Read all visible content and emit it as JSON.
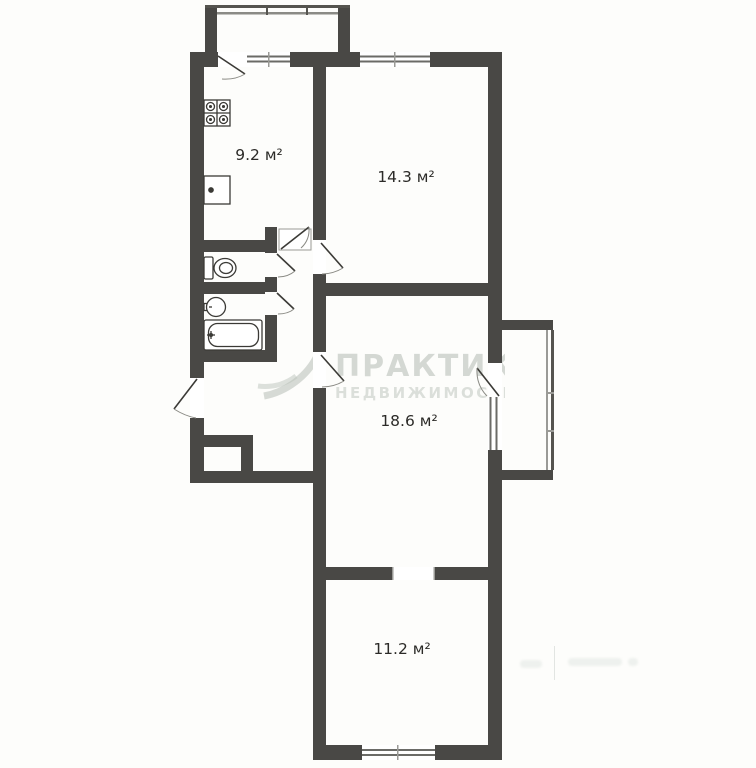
{
  "page": {
    "type": "apartment-floor-plan"
  },
  "rooms": [
    {
      "name": "kitchen",
      "area_label": "9.2 м²"
    },
    {
      "name": "bedroom",
      "area_label": "14.3 м²"
    },
    {
      "name": "living-room",
      "area_label": "18.6 м²"
    },
    {
      "name": "bedroom-2",
      "area_label": "11.2 м²"
    }
  ],
  "watermark": {
    "brand_line1": "ПРАКТИКА",
    "brand_line2": "НЕДВИЖИМОСТИ"
  },
  "fixtures": [
    "stove-icon",
    "kitchen-sink-icon",
    "toilet-icon",
    "washbasin-icon",
    "bathtub-icon"
  ],
  "features": [
    "balcony-top",
    "balcony-right",
    "entrance-door",
    "closet",
    "interior-doors",
    "windows"
  ],
  "colors": {
    "wall": "#494845",
    "line": "#55544f",
    "window_line": "#8b8b86",
    "label": "#2c2b28",
    "watermark": "#b4bbb4",
    "background": "#fdfdfb"
  }
}
